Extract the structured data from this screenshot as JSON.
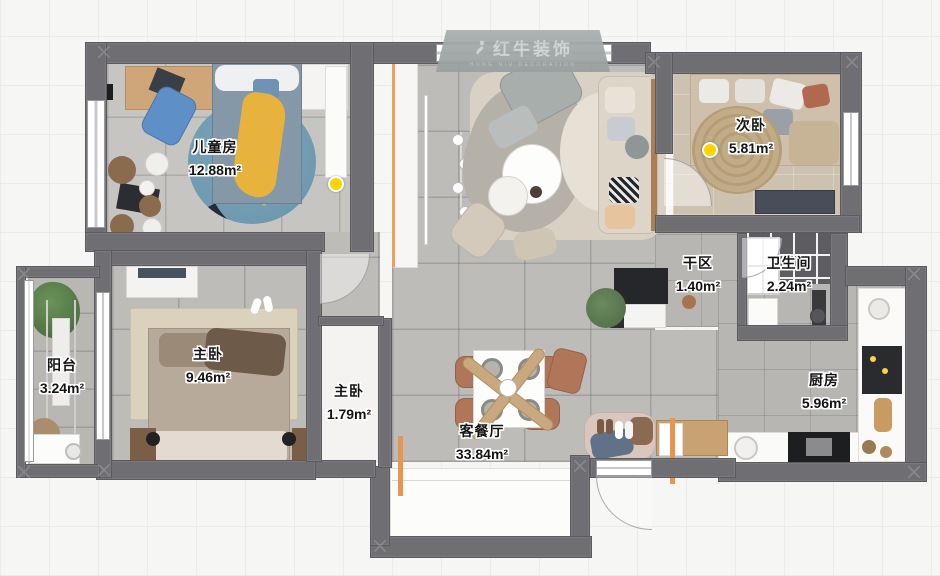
{
  "canvas": {
    "w": 940,
    "h": 576
  },
  "watermark": {
    "brand": "红牛装饰",
    "subtitle": "HONG NIU DECORATION"
  },
  "rooms": [
    {
      "name": "儿童房",
      "area": "12.88m²"
    },
    {
      "name": "次卧",
      "area": "5.81m²"
    },
    {
      "name": "干区",
      "area": "1.40m²"
    },
    {
      "name": "卫生间",
      "area": "2.24m²"
    },
    {
      "name": "主卧",
      "area": "9.46m²"
    },
    {
      "name": "主卧",
      "area": "1.79m²"
    },
    {
      "name": "阳台",
      "area": "3.24m²"
    },
    {
      "name": "客餐厅",
      "area": "33.84m²"
    },
    {
      "name": "厨房",
      "area": "5.96m²"
    }
  ],
  "decor": {
    "kids_rug_text": "SPACE"
  },
  "colors": {
    "wall": "#6f6f73",
    "floor_tile": "#bdbcb9",
    "bath_tile": "#5d5d61",
    "accent_wood": "#c9a87f",
    "accent_orange": "#e8964f",
    "marker_yellow": "#ffd400",
    "kids_rug_blue": "#6f9ab0"
  }
}
